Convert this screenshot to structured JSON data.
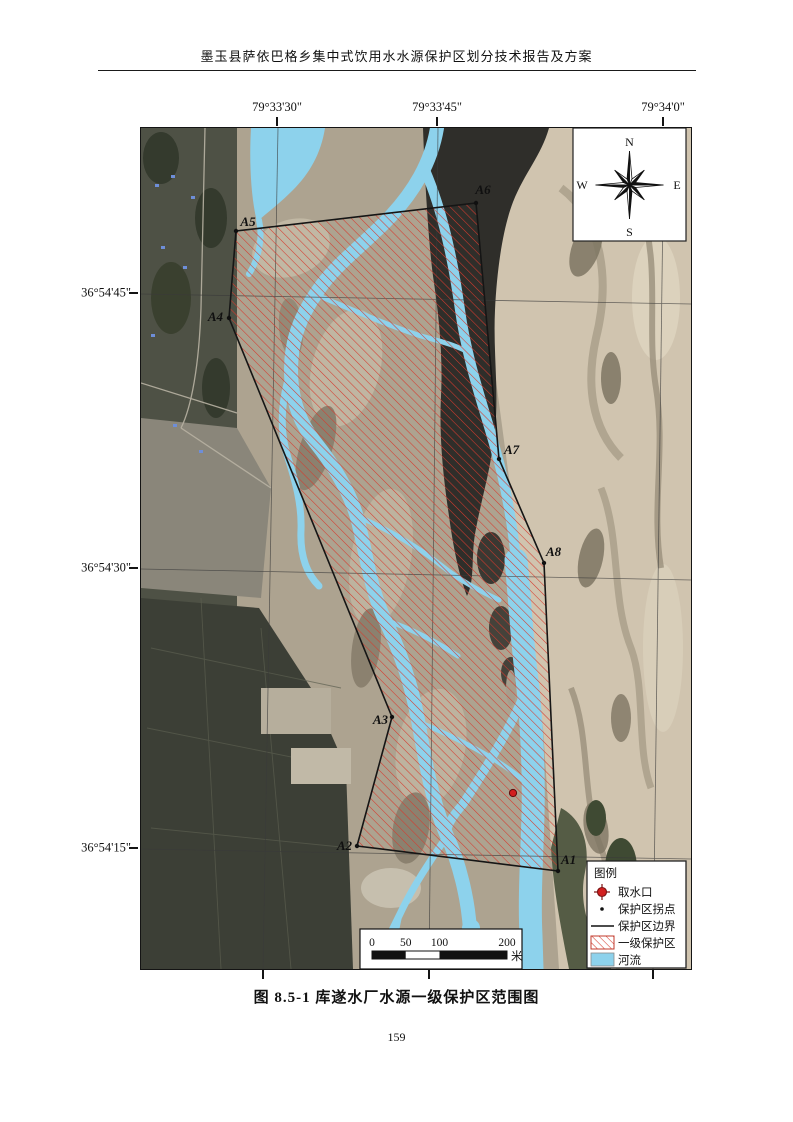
{
  "page": {
    "header_title": "墨玉县萨依巴格乡集中式饮用水水源保护区划分技术报告及方案",
    "figure_caption": "图 8.5-1  库遂水厂水源一级保护区范围图",
    "page_number": "159"
  },
  "map": {
    "longitudes": [
      "79°33'30\"",
      "79°33'45\"",
      "79°34'0\""
    ],
    "latitudes": [
      "36°54'45\"",
      "36°54'30\"",
      "36°54'15\""
    ],
    "vertices": [
      {
        "label": "A1"
      },
      {
        "label": "A2"
      },
      {
        "label": "A3"
      },
      {
        "label": "A4"
      },
      {
        "label": "A5"
      },
      {
        "label": "A6"
      },
      {
        "label": "A7"
      },
      {
        "label": "A8"
      }
    ],
    "compass": {
      "north": "N",
      "south": "S",
      "east": "E",
      "west": "W"
    },
    "legend": {
      "title": "图例",
      "items": [
        {
          "label": "取水口"
        },
        {
          "label": "保护区拐点"
        },
        {
          "label": "保护区边界"
        },
        {
          "label": "一级保护区"
        },
        {
          "label": "河流"
        }
      ]
    },
    "scalebar": {
      "ticks": [
        "0",
        "50",
        "100",
        "200"
      ],
      "unit": "米"
    },
    "colors": {
      "river": "#8dd2ec",
      "hatch_red": "#d63a2e",
      "boundary": "#151515",
      "intake_red": "#d21f1f"
    }
  }
}
